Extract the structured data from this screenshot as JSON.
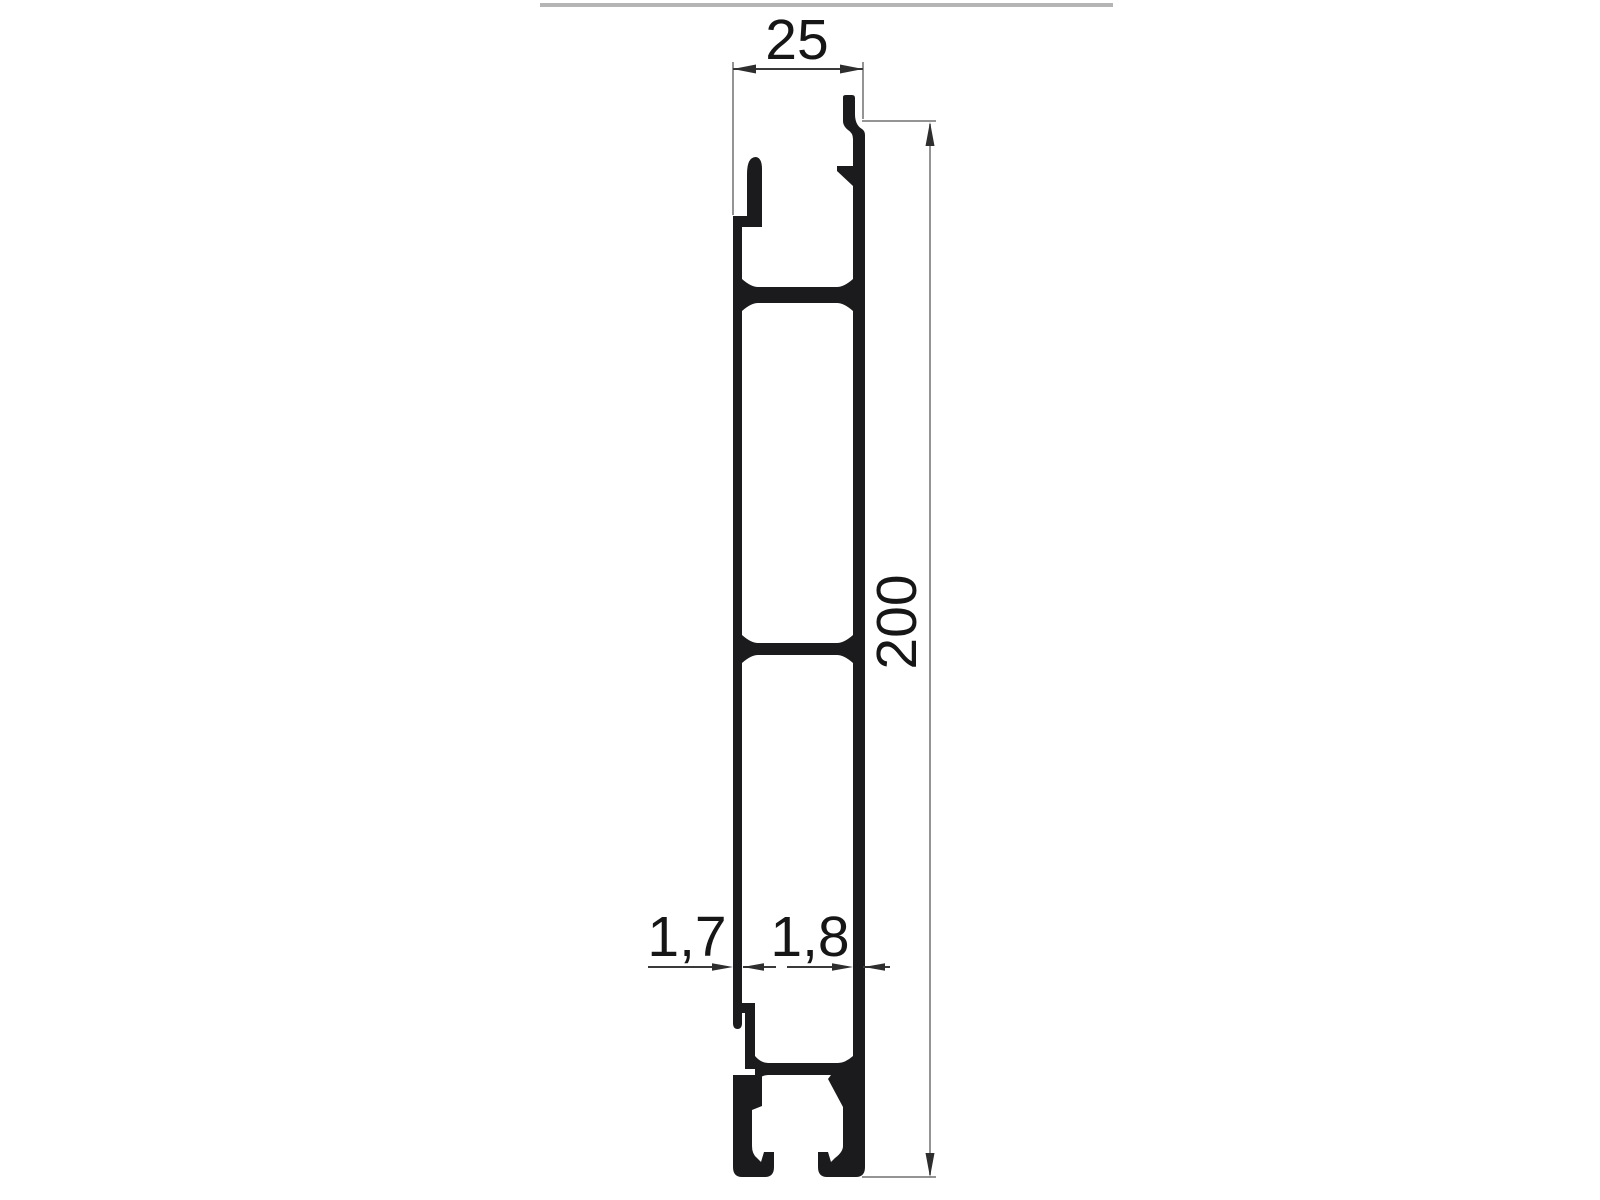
{
  "drawing": {
    "kind": "profile-cross-section",
    "dimensions": {
      "width": "25",
      "height": "200",
      "left_wall_thickness": "1,7",
      "right_wall_thickness": "1,8"
    }
  },
  "colors": {
    "background": "#ffffff",
    "profile": "#1b1b1d",
    "dim_dark": "#3a3a3a",
    "dim_light": "#949494",
    "arrow": "#2e2e2e",
    "text": "#161616",
    "top_border": "#b5b5b5"
  }
}
